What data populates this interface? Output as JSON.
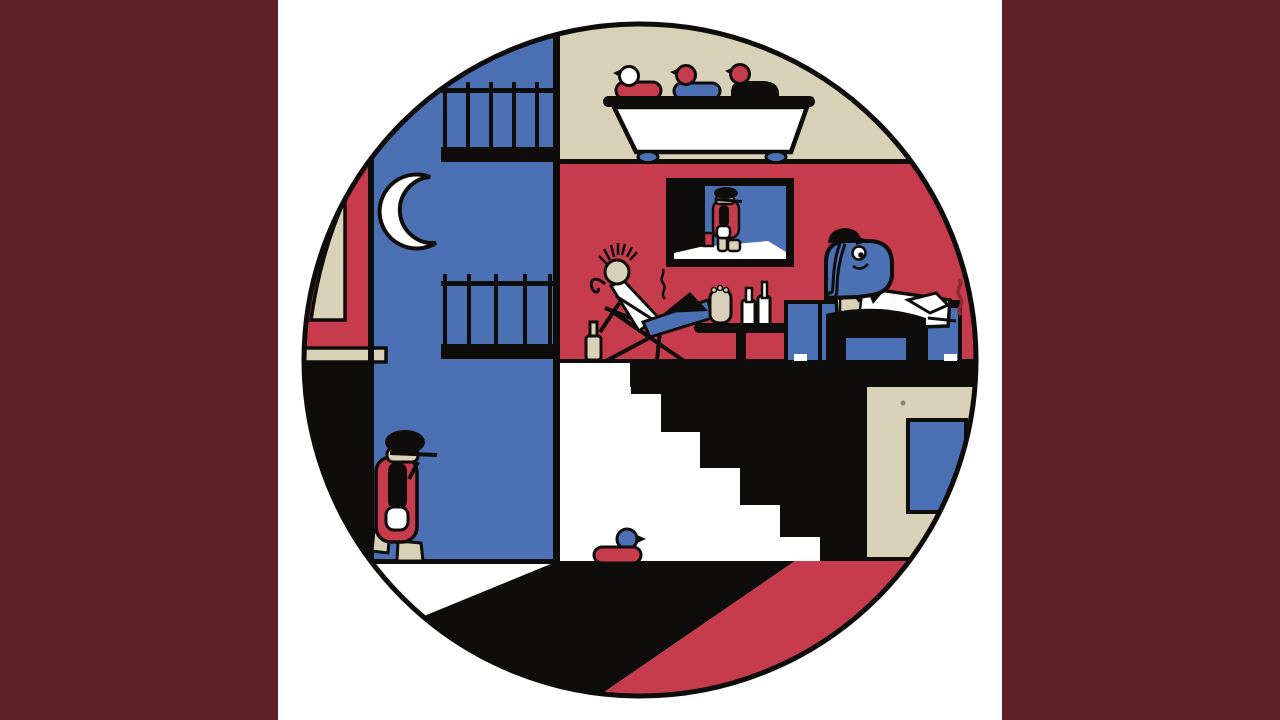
{
  "artwork": {
    "kind": "circular-album-art-illustration",
    "style": "flat geometric cartoon interior scene",
    "scene": {
      "sky": "night sky with crescent moon",
      "balconies": "two black iron balcony railings on blue wall",
      "bathroom": "bathtub with three ducks perched on its rim",
      "living_room": "red room with TV, reclining punk figure, pedestal table and bottles",
      "tv_picture": "framed picture of a hunched walker in bowler hat",
      "elephant": "blue elephant in white shirt and black cap smoking at a blue couch",
      "stairs": "black staircase descending to the right",
      "walker": "hunched figure in bowler hat and red coat walking at lower left",
      "rubber_duck": "red-bodied blue-headed duck on the floor",
      "carpet": "red diagonal carpet at bottom right"
    }
  },
  "palette": {
    "background": "#ffffff",
    "sidebar": "#5e2126",
    "ink": "#0e0d0b",
    "red": "#c63c4c",
    "darkred": "#8c2a34",
    "blue": "#4c70b4",
    "beige": "#d9d1b7",
    "white": "#ffffff"
  }
}
